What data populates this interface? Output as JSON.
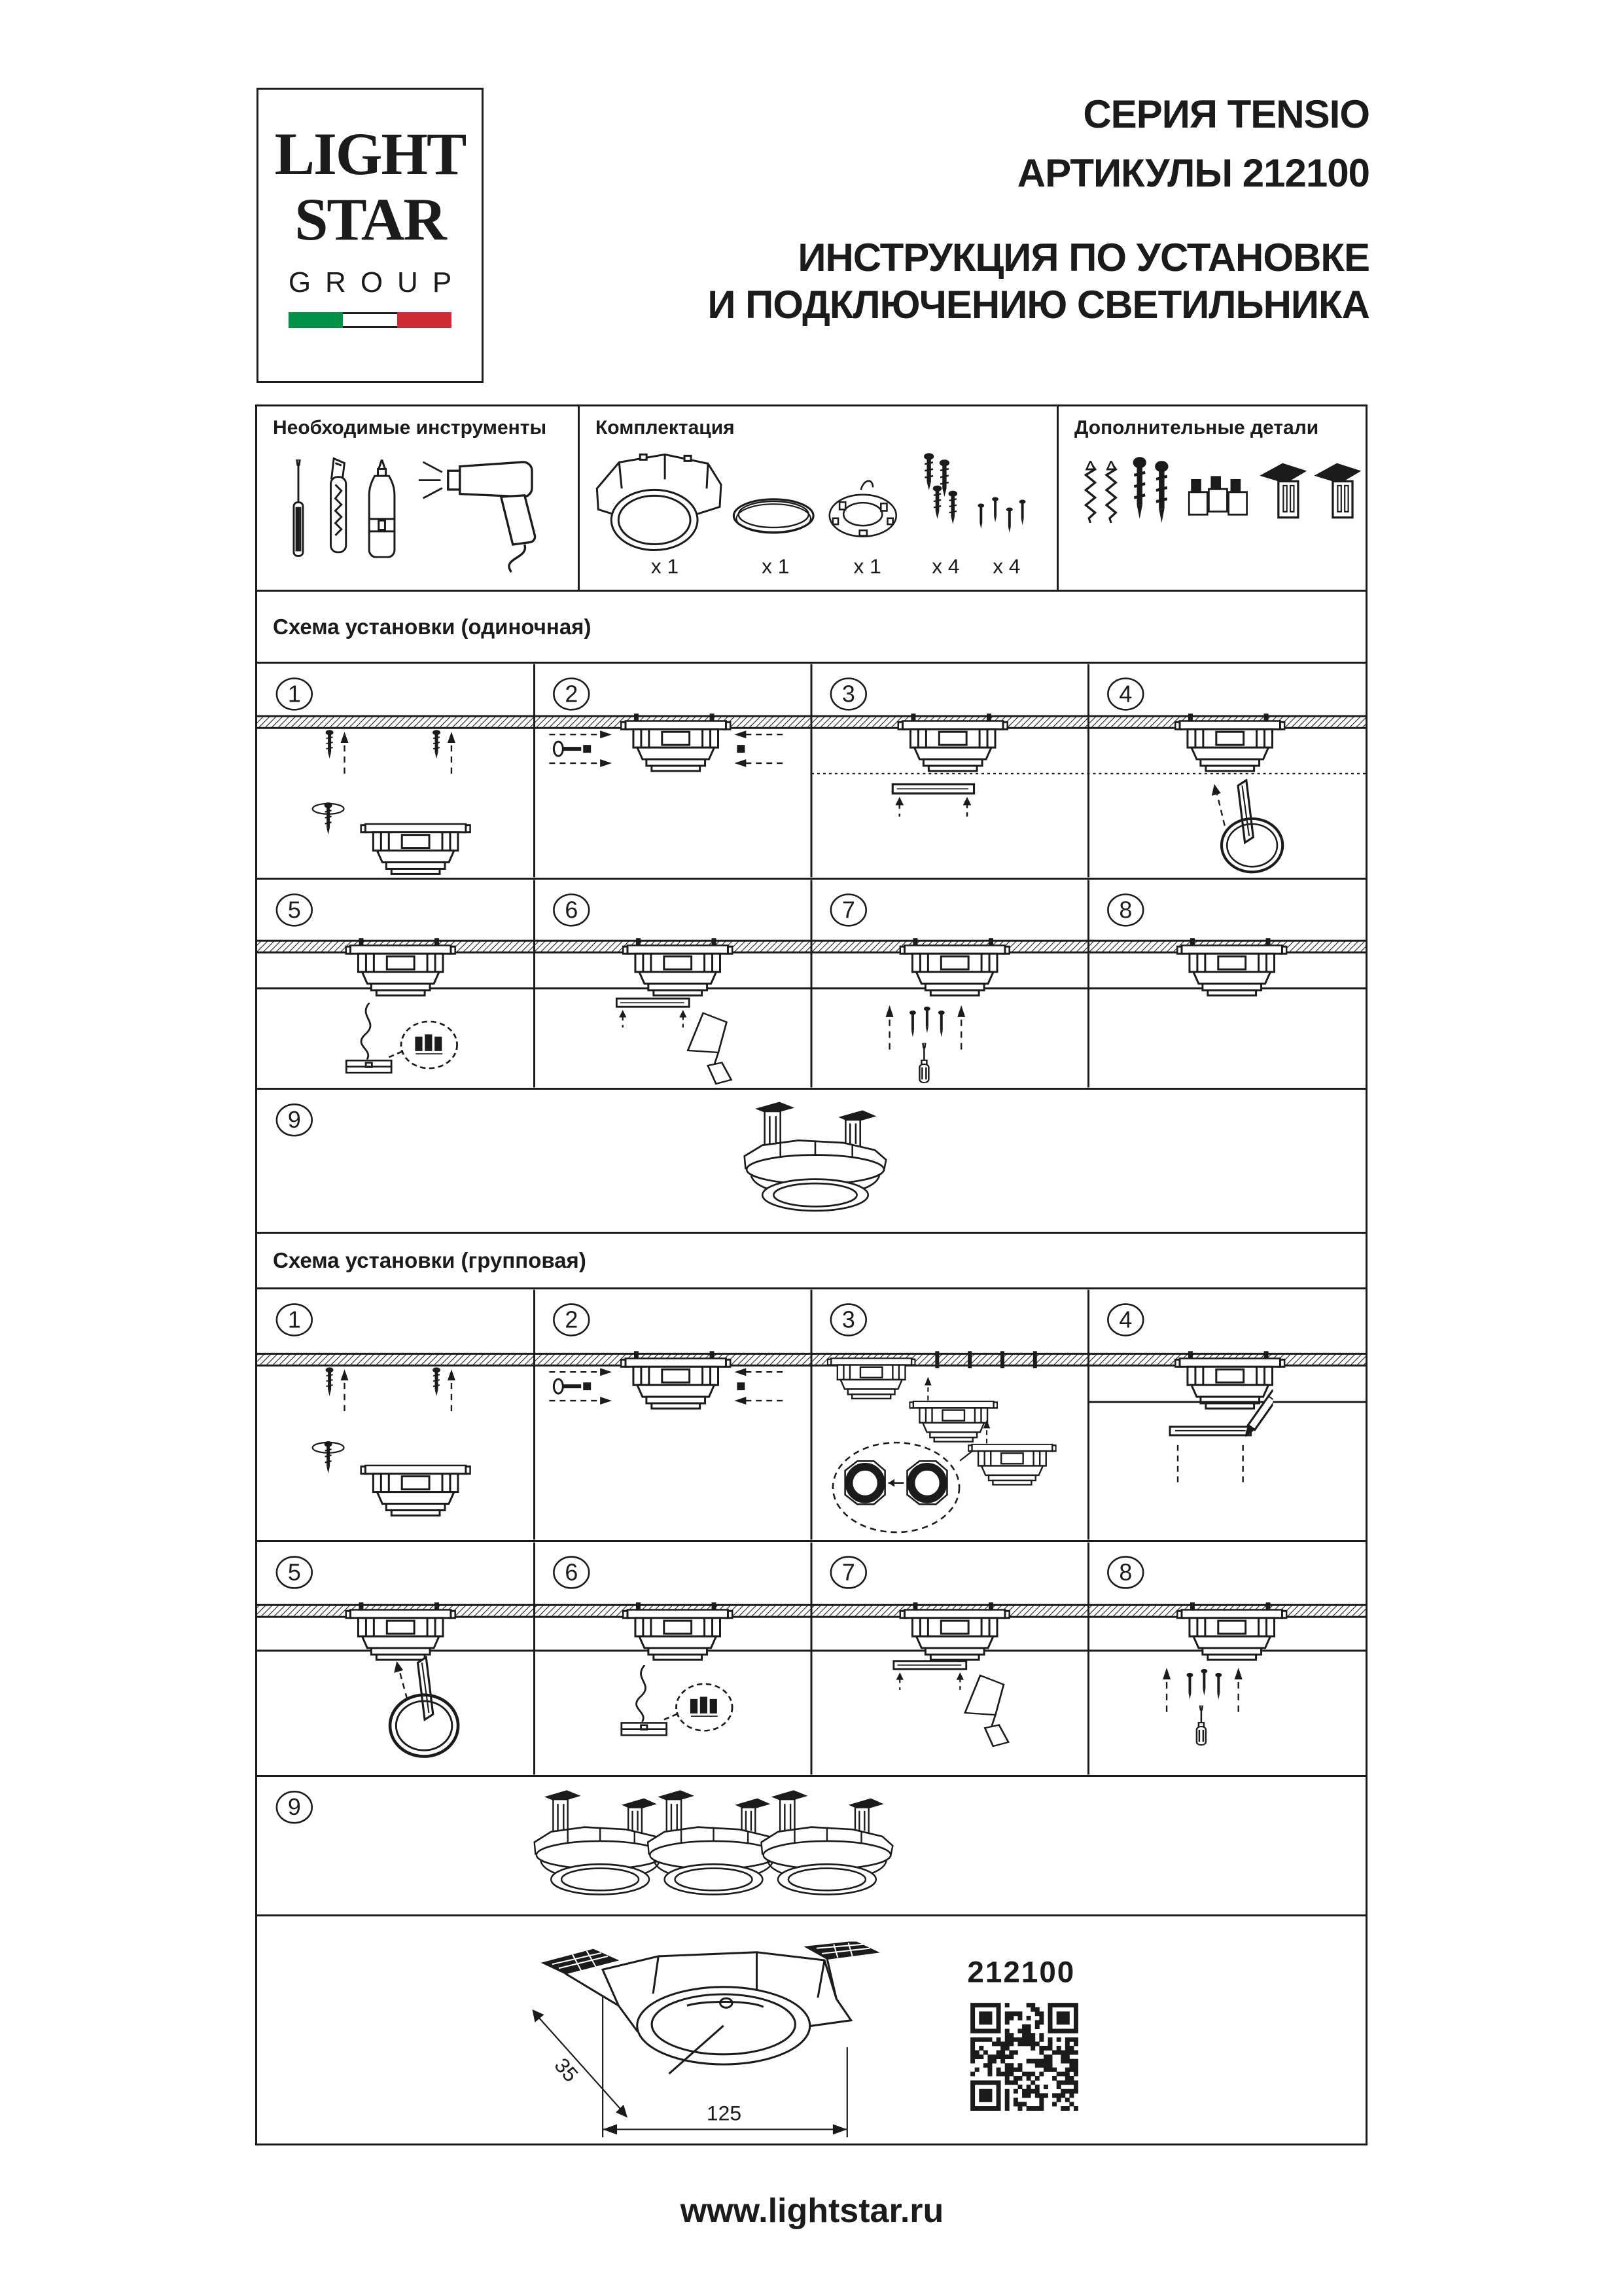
{
  "logo": {
    "line1": "LIGHT",
    "line2": "STAR",
    "line3": "GROUP",
    "flag_icon": "italian-flag"
  },
  "header": {
    "series": "СЕРИЯ TENSIO",
    "articles": "АРТИКУЛЫ 212100",
    "instruction1": "ИНСТРУКЦИЯ ПО УСТАНОВКЕ",
    "instruction2": "И ПОДКЛЮЧЕНИЮ СВЕТИЛЬНИКА"
  },
  "parts": {
    "tools_title": "Необходимые инструменты",
    "kit_title": "Комплектация",
    "extras_title": "Дополнительные детали",
    "tools_icons": [
      "screwdriver-icon",
      "utility-knife-icon",
      "glue-bottle-icon",
      "heat-gun-icon"
    ],
    "kit_items": [
      "mounting-frame-icon",
      "o-ring-icon",
      "fixing-ring-icon",
      "screws-icon",
      "small-screws-icon"
    ],
    "kit_quantities": [
      "x 1",
      "x 1",
      "x 1",
      "x 4",
      "x 4"
    ],
    "extras_items": [
      "dowels-icon",
      "screws-icon",
      "wire-connectors-icon",
      "bracket-icon",
      "bracket-icon"
    ]
  },
  "sections": {
    "single_title": "Схема установки (одиночная)",
    "group_title": "Схема установки (групповая)"
  },
  "steps": [
    "1",
    "2",
    "3",
    "4",
    "5",
    "6",
    "7",
    "8",
    "9"
  ],
  "final": {
    "article": "212100",
    "dim_width": "125",
    "dim_depth": "35"
  },
  "footer": {
    "url": "www.lightstar.ru"
  },
  "colors": {
    "ink": "#1b1b1b",
    "flag_green": "#009246",
    "flag_red": "#ce2b37"
  }
}
